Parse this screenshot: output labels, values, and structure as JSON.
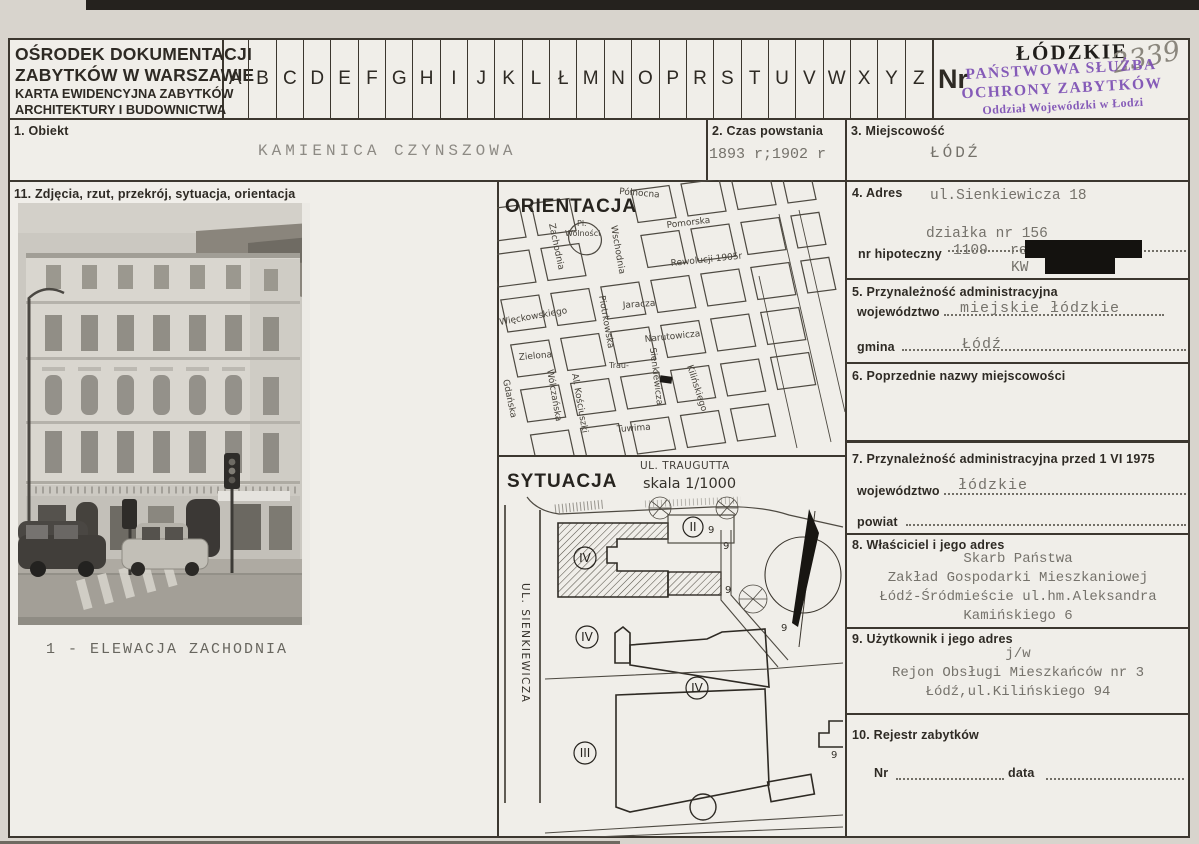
{
  "colors": {
    "stamp_purple": "#7d4fb4",
    "typewriter_ink": "#75726b",
    "pencil_gray": "#8a867d"
  },
  "header": {
    "org_lines": [
      "OŚRODEK DOKUMENTACJI",
      "ZABYTKÓW W WARSZAWIE",
      "KARTA EWIDENCYJNA ZABYTKÓW",
      "ARCHITEKTURY I BUDOWNICTWA"
    ],
    "alphabet": [
      "A",
      "B",
      "C",
      "D",
      "E",
      "F",
      "G",
      "H",
      "I",
      "J",
      "K",
      "L",
      "Ł",
      "M",
      "N",
      "O",
      "P",
      "R",
      "S",
      "T",
      "U",
      "V",
      "W",
      "X",
      "Y",
      "Z"
    ],
    "nr_label": "Nr",
    "voivodeship_stamp": "ŁÓDZKIE",
    "card_number": "2339",
    "office_stamp_lines": [
      "PAŃSTWOWA SŁUŻBA",
      "OCHRONY ZABYTKÓW",
      "Oddział Wojewódzki w Łodzi"
    ]
  },
  "fields": {
    "obiekt": {
      "label": "1. Obiekt",
      "value": "KAMIENICA CZYNSZOWA"
    },
    "czas_powstania": {
      "label": "2. Czas powstania",
      "value": "1893 r;1902 r"
    },
    "miejscowosc": {
      "label": "3. Miejscowość",
      "value": "ŁÓDŹ"
    },
    "adres": {
      "label": "4. Adres",
      "street": "ul.Sienkiewicza 18",
      "parcel": "działka nr 156",
      "hipoteczny_label": "nr hipoteczny",
      "hipoteczny_value": "1109",
      "rep_hip": "rep.hip.",
      "kw_label": "KW"
    },
    "przynaleznosc": {
      "label": "5. Przynależność administracyjna",
      "wojewodztwo_label": "województwo",
      "wojewodztwo_value": "miejskie łódzkie",
      "gmina_label": "gmina",
      "gmina_value": "Łódź"
    },
    "poprzednie_nazwy": {
      "label": "6. Poprzednie nazwy miejscowości"
    },
    "przynaleznosc_1975": {
      "label": "7. Przynależność administracyjna przed 1 VI 1975",
      "wojewodztwo_label": "województwo",
      "wojewodztwo_value": "łódzkie",
      "powiat_label": "powiat"
    },
    "wlasciciel": {
      "label": "8. Właściciel i jego adres",
      "lines": [
        "Skarb Państwa",
        "Zakład Gospodarki Mieszkaniowej",
        "Łódź-Śródmieście ul.hm.Aleksandra",
        "Kamińskiego 6"
      ]
    },
    "uzytkownik": {
      "label": "9. Użytkownik i jego adres",
      "lines": [
        "j/w",
        "Rejon Obsługi Mieszkańców nr 3",
        "Łódź,ul.Kilińskiego 94"
      ]
    },
    "rejestr": {
      "label": "10. Rejestr zabytków",
      "nr_label": "Nr",
      "data_label": "data"
    },
    "zdjecia": {
      "label": "11. Zdjęcia, rzut, przekrój, sytuacja, orientacja"
    }
  },
  "photo": {
    "caption": "1 - ELEWACJA ZACHODNIA"
  },
  "orientacja": {
    "title": "ORIENTACJA",
    "streets": {
      "polnocna": "Północna",
      "pomorska": "Pomorska",
      "rewolucji": "Rewolucji 1905r",
      "jaracza": "Jaracza",
      "narutowicza": "Narutowicza",
      "wieckowskiego": "Więckowskiego",
      "zielona": "Zielona",
      "zachodnia": "Zachodnia",
      "wschodnia": "Wschodnia",
      "pl_wolnosci_line1": "Pl.",
      "pl_wolnosci_line2": "Wolności",
      "piotrkowska": "Piotrkowska",
      "wolczanska": "Wólczańska",
      "kosciuszki": "Al. Kościuszki",
      "gdanska": "Gdańska",
      "sienkiewicza": "Sienkiewicza",
      "kilinskiego": "Kilińskiego",
      "traugutta": "Trau-",
      "tuwima": "Tuwima"
    }
  },
  "sytuacja": {
    "title": "SYTUACJA",
    "scale": "skala 1/1000",
    "street_top": "UL. TRAUGUTTA",
    "street_left": "UL. SIENKIEWICZA",
    "numeral_iv": "IV",
    "numeral_ii": "II",
    "numeral_iii": "III",
    "height_mark": "9"
  }
}
